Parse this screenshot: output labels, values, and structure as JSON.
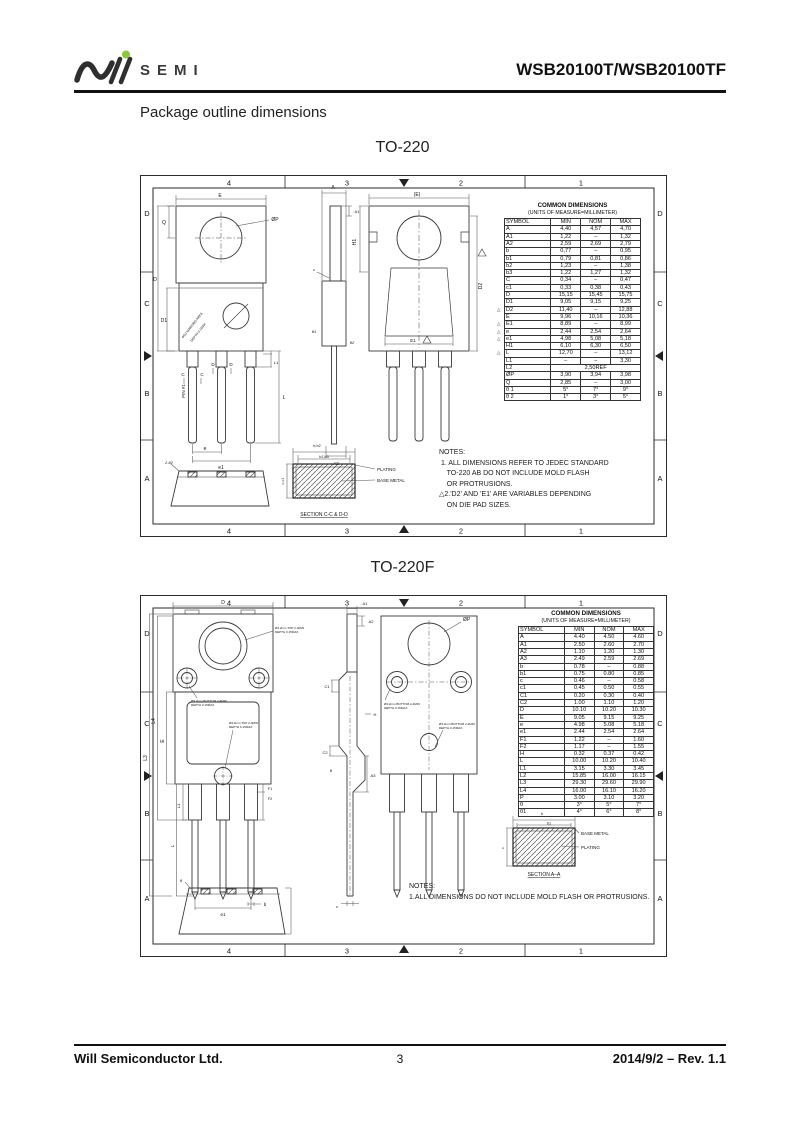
{
  "header": {
    "logo_text": "SEMI",
    "part_number": "WSB20100T/WSB20100TF"
  },
  "page": {
    "section_title": "Package outline dimensions",
    "to220_title": "TO-220",
    "to220f_title": "TO-220F"
  },
  "footer": {
    "company": "Will Semiconductor Ltd.",
    "page_number": "3",
    "revision": "2014/9/2 – Rev. 1.1"
  },
  "frame": {
    "cols": [
      "4",
      "3",
      "2",
      "1"
    ],
    "rows": [
      "D",
      "C",
      "B",
      "A"
    ]
  },
  "to220": {
    "table": {
      "title": "COMMON DIMENSIONS",
      "subtitle": "(UNITS OF MEASURE=MILLIMETER)",
      "headers": [
        "SYMBOL",
        "MIN",
        "NOM",
        "MAX"
      ],
      "rows": [
        [
          "A",
          "4,40",
          "4,57",
          "4,70"
        ],
        [
          "A1",
          "1,22",
          "–",
          "1,32"
        ],
        [
          "A2",
          "2,59",
          "2,69",
          "2,79"
        ],
        [
          "b",
          "0,77",
          "–",
          "0,95"
        ],
        [
          "b1",
          "0,79",
          "0,81",
          "0,86"
        ],
        [
          "b2",
          "1,23",
          "–",
          "1,38"
        ],
        [
          "b3",
          "1,22",
          "1,27",
          "1,32"
        ],
        [
          "C",
          "0,34",
          "–",
          "0,47"
        ],
        [
          "c1",
          "0,33",
          "0,38",
          "0,43"
        ],
        [
          "D",
          "15,15",
          "15,45",
          "15,75"
        ],
        [
          "D1",
          "9,05",
          "9,15",
          "9,25"
        ],
        [
          "D2",
          "11,40",
          "–",
          "12,88"
        ],
        [
          "E",
          "9,96",
          "10,16",
          "10,36"
        ],
        [
          "E1",
          "8,89",
          "–",
          "8,99"
        ],
        [
          "e",
          "2,44",
          "2,54",
          "2,64"
        ],
        [
          "e1",
          "4,98",
          "5,08",
          "5,18"
        ],
        [
          "H1",
          "6,10",
          "6,30",
          "6,50"
        ],
        [
          "L",
          "12,70",
          "–",
          "13,12"
        ],
        [
          "L1",
          "–",
          "–",
          "3,30"
        ],
        [
          "L2",
          "2,50REF"
        ],
        [
          "ØP",
          "3,90",
          "3,94",
          "3,98"
        ],
        [
          "Q",
          "2,85",
          "–",
          "3,00"
        ],
        [
          "θ 1",
          "5°",
          "7°",
          "9°"
        ],
        [
          "θ 2",
          "1°",
          "3°",
          "5°"
        ]
      ],
      "flagged": [
        "D2",
        "E1",
        "e",
        "e1",
        "L"
      ]
    },
    "notes": [
      "NOTES:",
      " 1. ALL DIMENSIONS REFER TO JEDEC STANDARD",
      "    TO-220 AB DO NOT INCLUDE MOLD FLASH",
      "    OR PROTRUSIONS.",
      "△2.'D2' AND 'E1' ARE VARIABLES DEPENDING",
      "    ON DIE PAD SIZES."
    ],
    "labels": {
      "E": "E",
      "Q": "Q",
      "D": "D",
      "D1": "D1",
      "phiP": "ØP",
      "e": "e",
      "e1": "e1",
      "L": "L",
      "L1": "L1",
      "pin1": "PIN #1",
      "C": "C",
      "Dcallout": "D",
      "A": "A",
      "A1": "A1",
      "A2": "A2",
      "c": "c",
      "theta1": "θ1",
      "theta2": "θ2",
      "Eback": "(E)",
      "H1": "H1",
      "D2": "D2",
      "E1": "E1",
      "bottom_note": "2-θ2",
      "marking1": "ΦD2 MARKING AREA",
      "marking2": "DEPTH 0.1MAX",
      "sec_top": "b,b2",
      "sec_in": "b1,b3",
      "sec_left": "c,c1",
      "plating": "PLATING",
      "base_metal": "BASE METAL",
      "section": "SECTION C-C & D-D"
    }
  },
  "to220f": {
    "table": {
      "title": "COMMON DIMENSIONS",
      "subtitle": "(UNITS OF MEASURE=MILLIMETER)",
      "headers": [
        "SYMBOL",
        "MIN",
        "NOM",
        "MAX"
      ],
      "rows": [
        [
          "A",
          "4.40",
          "4.50",
          "4.60"
        ],
        [
          "A1",
          "2.50",
          "2.60",
          "2.70"
        ],
        [
          "A2",
          "1.10",
          "1.20",
          "1.30"
        ],
        [
          "A3",
          "2.49",
          "2.59",
          "2.69"
        ],
        [
          "b",
          "0.78",
          "–",
          "0.88"
        ],
        [
          "b1",
          "0.75",
          "0.80",
          "0.85"
        ],
        [
          "c",
          "0.46",
          "–",
          "0.58"
        ],
        [
          "c1",
          "0.45",
          "0.50",
          "0.55"
        ],
        [
          "C1",
          "0.20",
          "0.30",
          "0.40"
        ],
        [
          "C2",
          "1.00",
          "1.10",
          "1.20"
        ],
        [
          "D",
          "10.10",
          "10.20",
          "10.30"
        ],
        [
          "E",
          "9.05",
          "9.15",
          "9.25"
        ],
        [
          "e",
          "4.98",
          "5.08",
          "5.18"
        ],
        [
          "e1",
          "2.44",
          "2.54",
          "2.64"
        ],
        [
          "F1",
          "1.22",
          "–",
          "1.60"
        ],
        [
          "F2",
          "1.17",
          "–",
          "1.55"
        ],
        [
          "H",
          "0.32",
          "0.37",
          "0.42"
        ],
        [
          "L",
          "10.00",
          "10.20",
          "10.40"
        ],
        [
          "L1",
          "3.15",
          "3.30",
          "3.45"
        ],
        [
          "L2",
          "15.85",
          "16.00",
          "16.15"
        ],
        [
          "L3",
          "29.30",
          "29.60",
          "29.90"
        ],
        [
          "L4",
          "16.00",
          "16.10",
          "16.20"
        ],
        [
          "P",
          "3.00",
          "3.10",
          "3.20"
        ],
        [
          "θ",
          "3°",
          "5°",
          "7°"
        ],
        [
          "θ1",
          "4°",
          "6°",
          "8°"
        ]
      ],
      "flagged": []
    },
    "notes": [
      "NOTES:",
      "1.ALL DIMENSIONS DO NOT INCLUDE MOLD FLASH OR PROTRUSIONS."
    ],
    "labels": {
      "D": "D",
      "L3": "L3",
      "L4": "L4",
      "E": "E",
      "L1": "L1",
      "L": "L",
      "e1": "e1",
      "b": "b",
      "F1": "F1",
      "F2": "F2",
      "A1": "A1",
      "A2": "A2",
      "C1": "C1",
      "C2": "C2",
      "H": "H",
      "theta": "θ",
      "A3": "A3",
      "c": "c",
      "phiP": "ØP",
      "ann_top": "Ø3.2mm TOP 2-4MIN",
      "ann_bot": "Ø3.2mm BOTTOM 2-4MIN",
      "ann_depth": "DEPTH 0.15MAX",
      "sec_b": "b",
      "sec_b1": "b1",
      "sec_c": "c",
      "plating": "PLATING",
      "base_metal": "BASE METAL",
      "section": "SECTION A–A"
    }
  }
}
